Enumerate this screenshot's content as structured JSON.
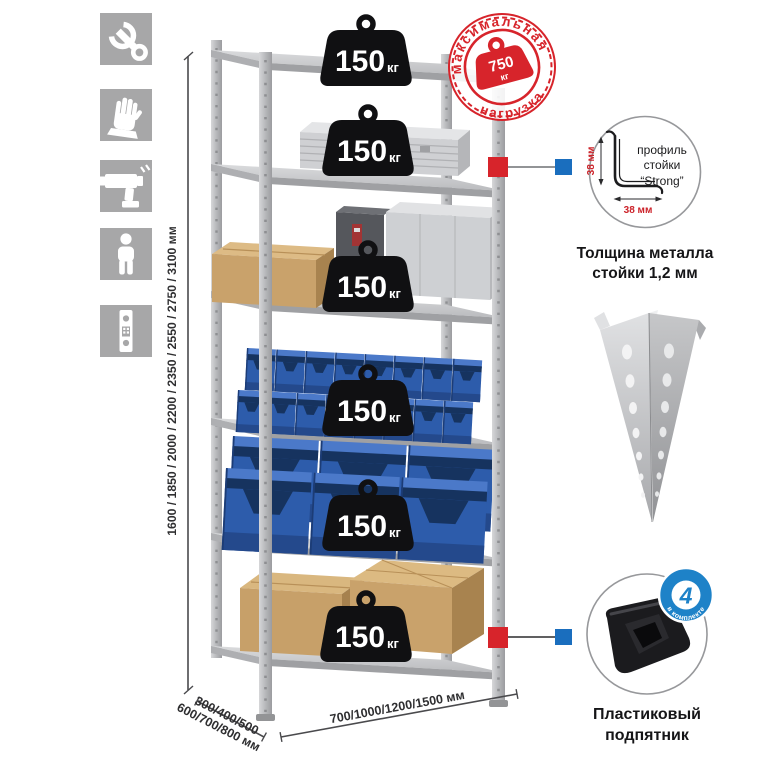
{
  "colors": {
    "accent_red": "#d7242b",
    "marker_blue": "#1a6ebe",
    "badge_blue": "#1e82c8",
    "bin_blue": "#2d5cab",
    "icon_tile_gray": "#a7a7a8"
  },
  "feature_icons": {
    "items": [
      {
        "name": "wrench-icon"
      },
      {
        "name": "gloves-icon"
      },
      {
        "name": "drill-icon"
      },
      {
        "name": "person-icon"
      },
      {
        "name": "rack-post-icon"
      }
    ]
  },
  "rack": {
    "shelf_count": 6,
    "shelf_load_badge": {
      "value": "150",
      "unit": "кг"
    }
  },
  "max_load_stamp": {
    "arc_top": "максимальная",
    "arc_bottom": "нагрузка",
    "value": "750",
    "unit": "кг"
  },
  "profile_detail": {
    "label_line1": "профиль",
    "label_line2": "стойки",
    "label_line3": "“Strong”",
    "dim_vertical": "38 мм",
    "dim_horizontal": "38 мм",
    "caption_line1": "Толщина металла",
    "caption_line2": "стойки 1,2 мм"
  },
  "foot_detail": {
    "badge_value": "4",
    "badge_arc": "в комплекте",
    "caption_line1": "Пластиковый",
    "caption_line2": "подпятник"
  },
  "dimensions": {
    "height_mm": "1600 / 1850 / 2000 / 2200 / 2350 / 2550 / 2750 / 3100 мм",
    "depth_line1": "300/400/500",
    "depth_line2": "600/700/800 мм",
    "width_mm": "700/1000/1200/1500 мм"
  }
}
